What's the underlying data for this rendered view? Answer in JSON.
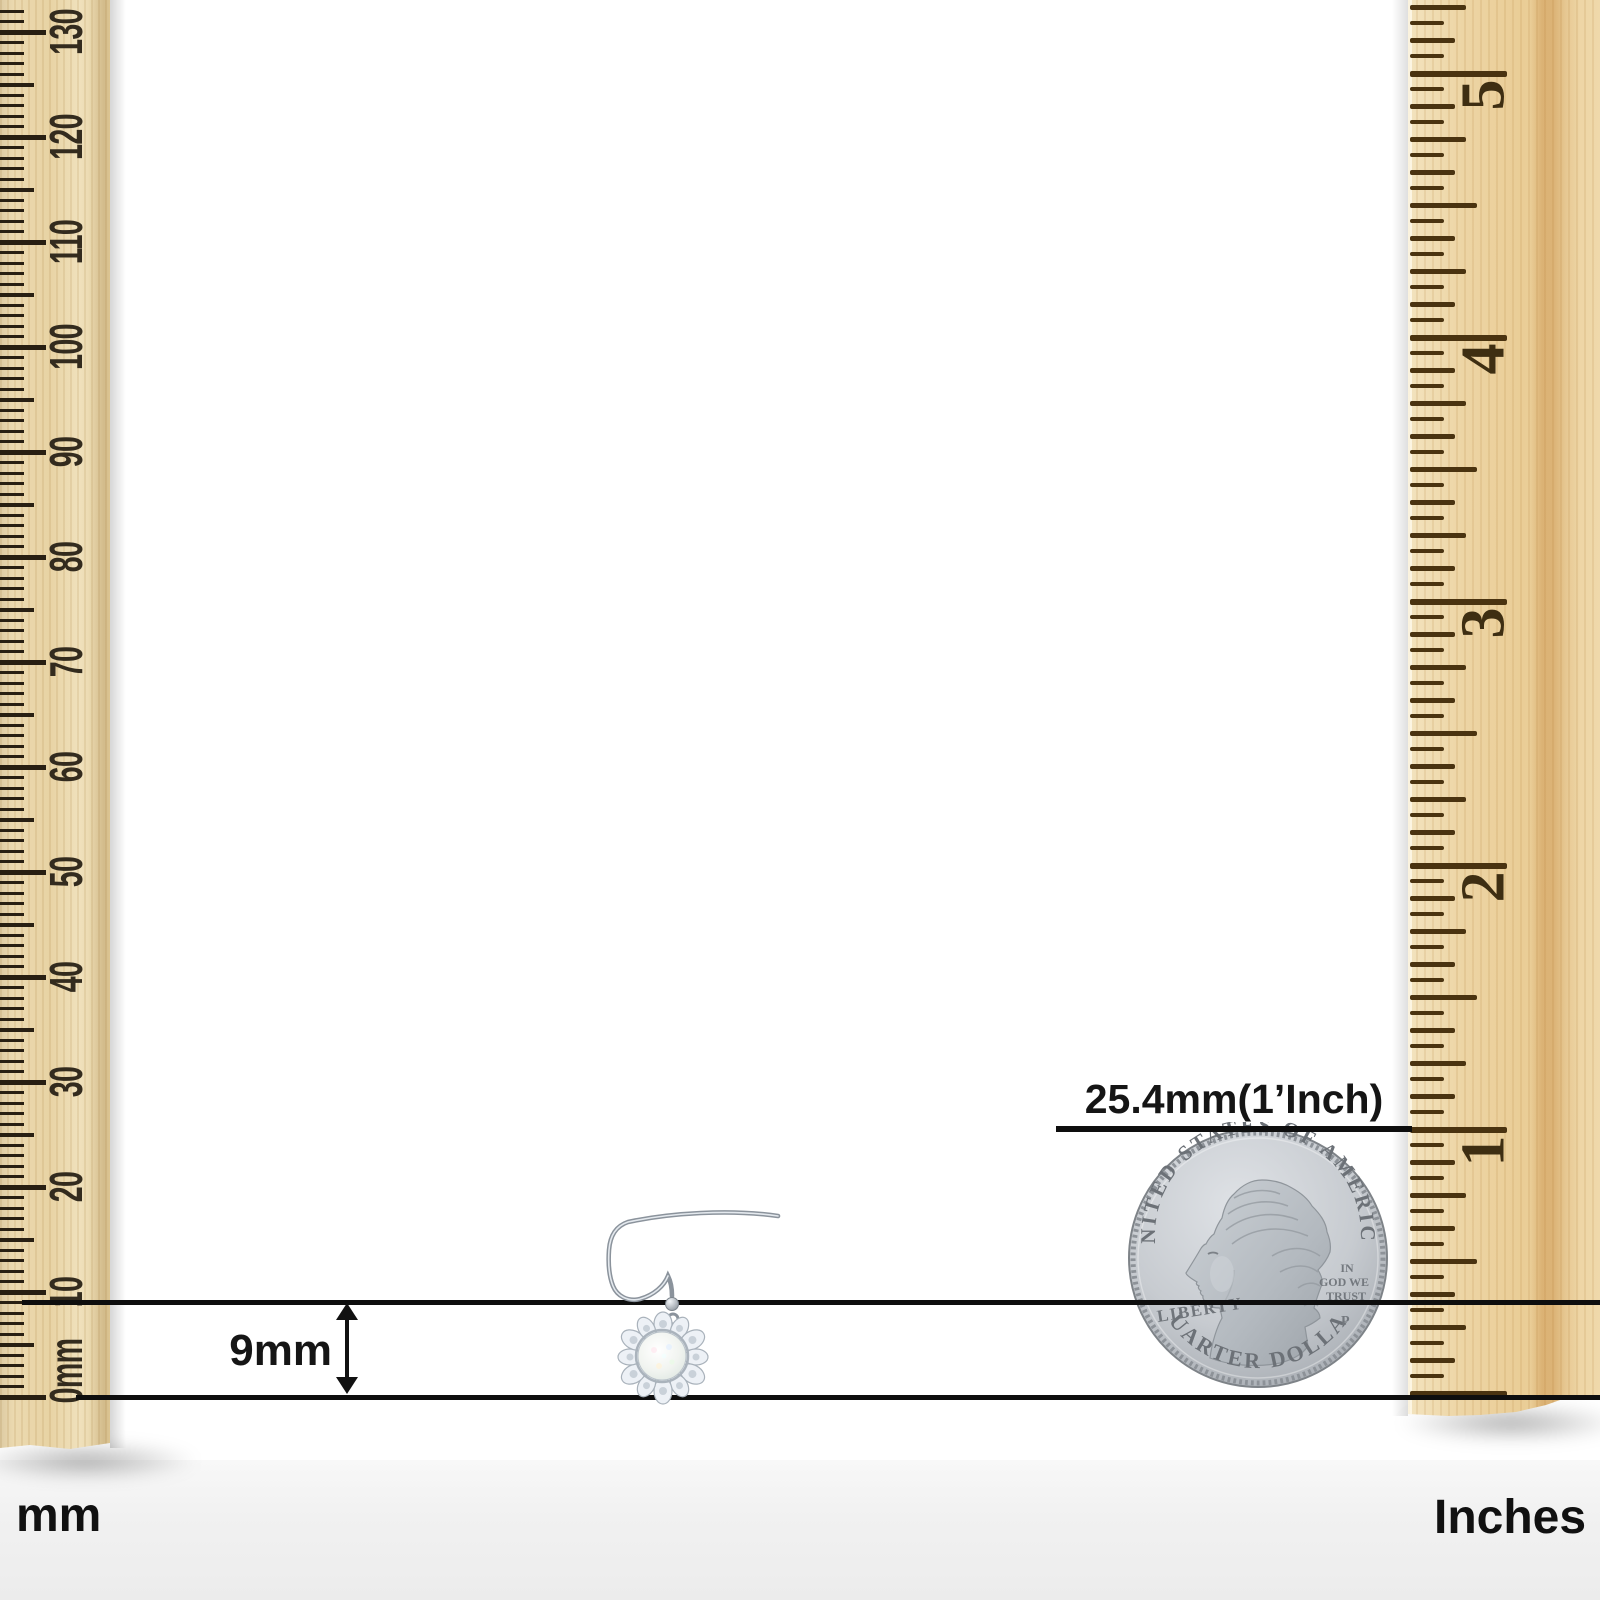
{
  "image_type": "jewelry size comparison diagram",
  "rulers": {
    "left": {
      "unit": "mm",
      "labels": [
        "0mm",
        "10",
        "20",
        "30",
        "40",
        "50",
        "60",
        "70",
        "80",
        "90",
        "100",
        "110",
        "120",
        "130"
      ],
      "geometry": {
        "zero_y": 1397,
        "px_per_mm": 10.5,
        "max_mm": 133,
        "label_x": 66
      }
    },
    "right": {
      "unit": "Inches",
      "labels": [
        "1",
        "2",
        "3",
        "4",
        "5"
      ],
      "geometry": {
        "zero_y": 1393,
        "px_per_sixteenth": 16.5,
        "max_sixteenths": 84,
        "label_x": 76,
        "label_dy": 22
      }
    }
  },
  "annotations": {
    "coin_size_label": "25.4mm(1’Inch)",
    "earring_size_label": "9mm"
  },
  "units": {
    "left_bottom_label": "mm",
    "right_bottom_label": "Inches"
  },
  "coin": {
    "top_text": "UNITED STATES OF AMERICA",
    "bottom_text": "QUARTER DOLLAR",
    "left_text": "LIBERTY",
    "motto_lines": [
      "IN",
      "GOD WE",
      "TRUST"
    ],
    "mint_mark": "P"
  },
  "colors": {
    "measure_line": "#0e0e0e",
    "left_wood": "#e9d6ac",
    "right_wood": "#ecd2a0",
    "left_tick": "#281f12",
    "right_tick": "#4a3310",
    "coin_silver": "#c6cacf",
    "floor_gray": "#efefef"
  }
}
